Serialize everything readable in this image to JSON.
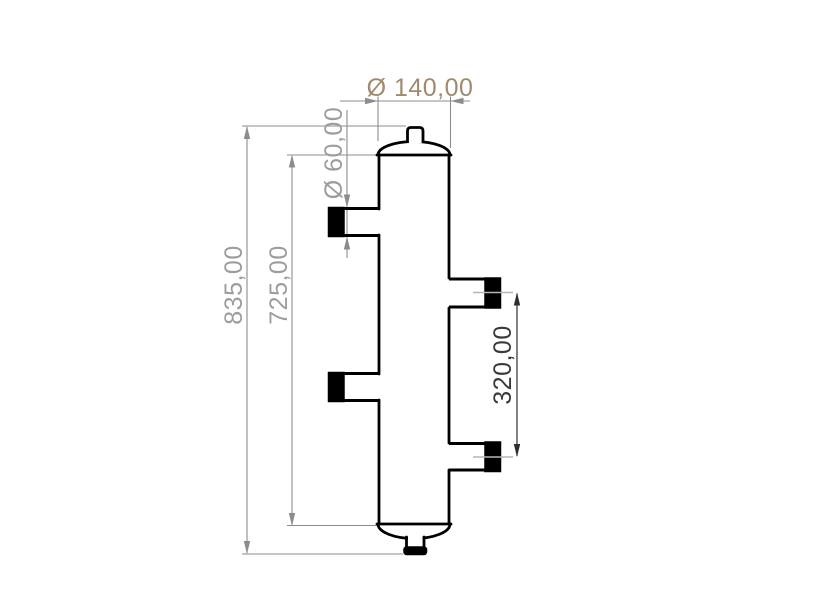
{
  "drawing": {
    "dimensions": {
      "total_height": {
        "label": "835,00"
      },
      "shell_length": {
        "label": "725,00"
      },
      "port_diameter": {
        "label": "Ø 60,00"
      },
      "body_diameter": {
        "label": "Ø 140,00"
      },
      "port_spacing": {
        "label": "320,00"
      }
    },
    "colors": {
      "background": "#ffffff",
      "outline": "#000000",
      "dim_line_gray": "#8c8c8c",
      "dim_text_gray": "#9d9d9d",
      "selected_dim_tan": "#a08a6e",
      "dim_dark_line": "#2e2e2e",
      "dim_dark_text": "#3a3a3a",
      "centerline_gray": "#b5b5b5"
    }
  }
}
